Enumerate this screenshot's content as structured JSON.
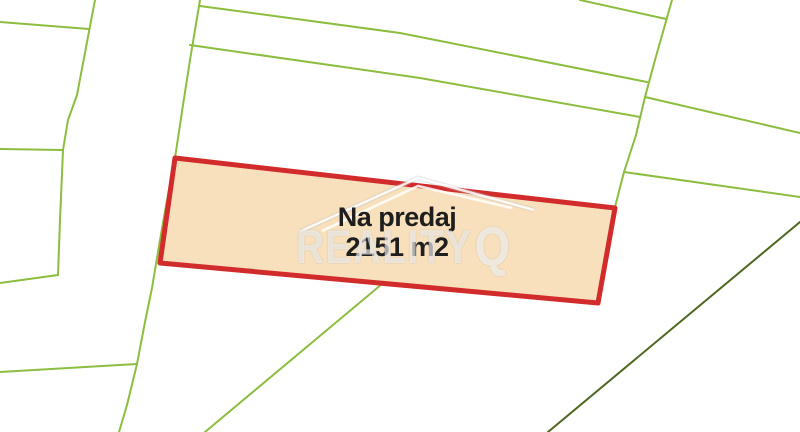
{
  "map": {
    "parcel": {
      "status_label": "Na predaj",
      "area_label": "2151 m2"
    },
    "watermark": {
      "brand_text": "REALITY",
      "logo_letter": "Q"
    },
    "colors": {
      "background": "#FFFFFF",
      "boundary_green": "#8CBD3F",
      "boundary_dark_green": "#4E661F",
      "parcel_border_red": "#D22B2B",
      "parcel_fill": "#F8E0BC",
      "label_text": "#1E1E1E"
    }
  }
}
